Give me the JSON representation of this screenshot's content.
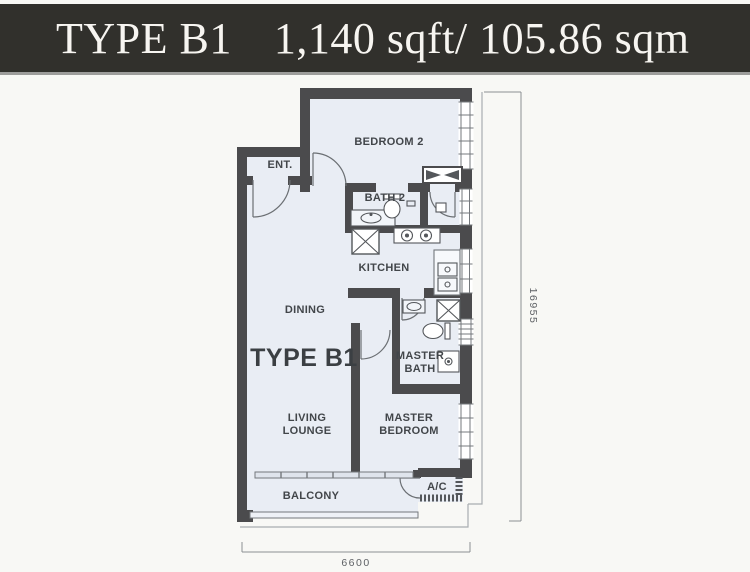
{
  "header": {
    "plan_type": "TYPE B1",
    "area": "1,140 sqft/ 105.86 sqm"
  },
  "rooms": {
    "ent": "ENT.",
    "bedroom2": "BEDROOM 2",
    "bath2": "BATH 2",
    "kitchen": "KITCHEN",
    "dining": "DINING",
    "plan_type_label": "TYPE B1",
    "master_bath_line1": "MASTER",
    "master_bath_line2": "BATH",
    "living_line1": "LIVING",
    "living_line2": "LOUNGE",
    "master_bed_line1": "MASTER",
    "master_bed_line2": "BEDROOM",
    "balcony": "BALCONY",
    "ac": "A/C"
  },
  "dimensions": {
    "vertical": "16955",
    "horizontal": "6600"
  },
  "colors": {
    "header_bg": "#31302c",
    "header_text": "#f7f5f1",
    "wall": "#4b4b4d",
    "floor": "#e9edf4",
    "line": "#74787c",
    "label": "#42464a"
  }
}
